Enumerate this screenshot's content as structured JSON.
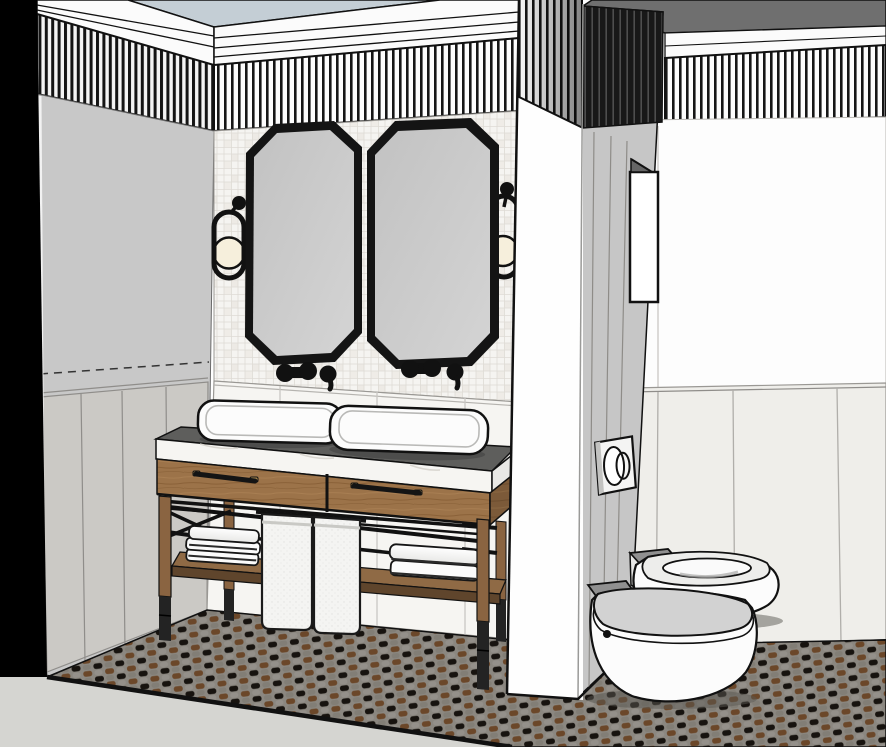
{
  "meta": {
    "title": "Bathroom interior 3D render",
    "render_style": "SketchUp-style perspective line render",
    "width_px": 886,
    "height_px": 747
  },
  "colors": {
    "background": "#ffffff",
    "ceiling": "#c4ced5",
    "roof_plane": "#6f6f6f",
    "crown_white": "#fbfbfb",
    "left_wall": "#c8c8c8",
    "left_wainscot": "#cbc9c5",
    "tile_base": "#f5f4f1",
    "tile_shade": "#edeae5",
    "tile_grid": "#dedbd5",
    "back_wainscot": "#f6f5f2",
    "right_wall": "#fdfdfd",
    "right_wainscot": "#efeeea",
    "partition_front": "#fefefe",
    "partition_side": "#c6c6c6",
    "niche_white": "#ffffff",
    "outline": "#111111",
    "stripe_black": "#161616",
    "mirror_frame": "#141414",
    "sconce_globe": "#f6efdc",
    "marble": "#f6f5f2",
    "marble_side": "#e9e8e5",
    "counter_deck": "#5e5e5c",
    "wood": "#9c7349",
    "wood_dark": "#7c5a39",
    "wood_shelf": "#8f6a45",
    "wood_shelf_edge": "#5f452c",
    "leg_wood": "#8a6441",
    "leg_black": "#232323",
    "handle_brass": "#ad8a4f",
    "towel_white": "#fbfbfb",
    "hanging_towel": "#f4f4f2",
    "floor_base": "#8b8780",
    "floor_brown": "#6b4729",
    "floor_black": "#17130f",
    "ground_outside": "#d5d5d1",
    "fixture_white": "#fcfcfc",
    "fixture_gray": "#909090",
    "seat_gray": "#d2d2d2",
    "flush_plate": "#f4f4f3"
  },
  "scene": {
    "room": "bathroom",
    "view": "corner perspective facing double-vanity wall",
    "features": [
      "fluted cornice band",
      "light blue ceiling",
      "mosaic tile feature wall",
      "panel wainscoting",
      "patterned mosaic floor",
      "partition wall with niche opening"
    ],
    "objects": {
      "mirrors": {
        "count": 2,
        "shape": "octagonal",
        "frame": "black"
      },
      "sconces": {
        "count": 2,
        "style": "black oval ring with cream globe"
      },
      "faucets": {
        "count": 2,
        "type": "wall-mounted cross-handle",
        "finish": "black"
      },
      "sinks": {
        "count": 2,
        "type": "rectangular vessel",
        "color": "white"
      },
      "vanity": {
        "type": "double console",
        "material": "wood with black metal frame",
        "drawers": 2,
        "shelf": "open lower shelf"
      },
      "towels": {
        "folded_stacks": 2,
        "hanging": 2
      },
      "toilet": {
        "count": 1,
        "color": "white"
      },
      "bidet": {
        "count": 1,
        "color": "white"
      },
      "flush_plate": {
        "count": 1,
        "buttons": "dual oval"
      }
    }
  }
}
